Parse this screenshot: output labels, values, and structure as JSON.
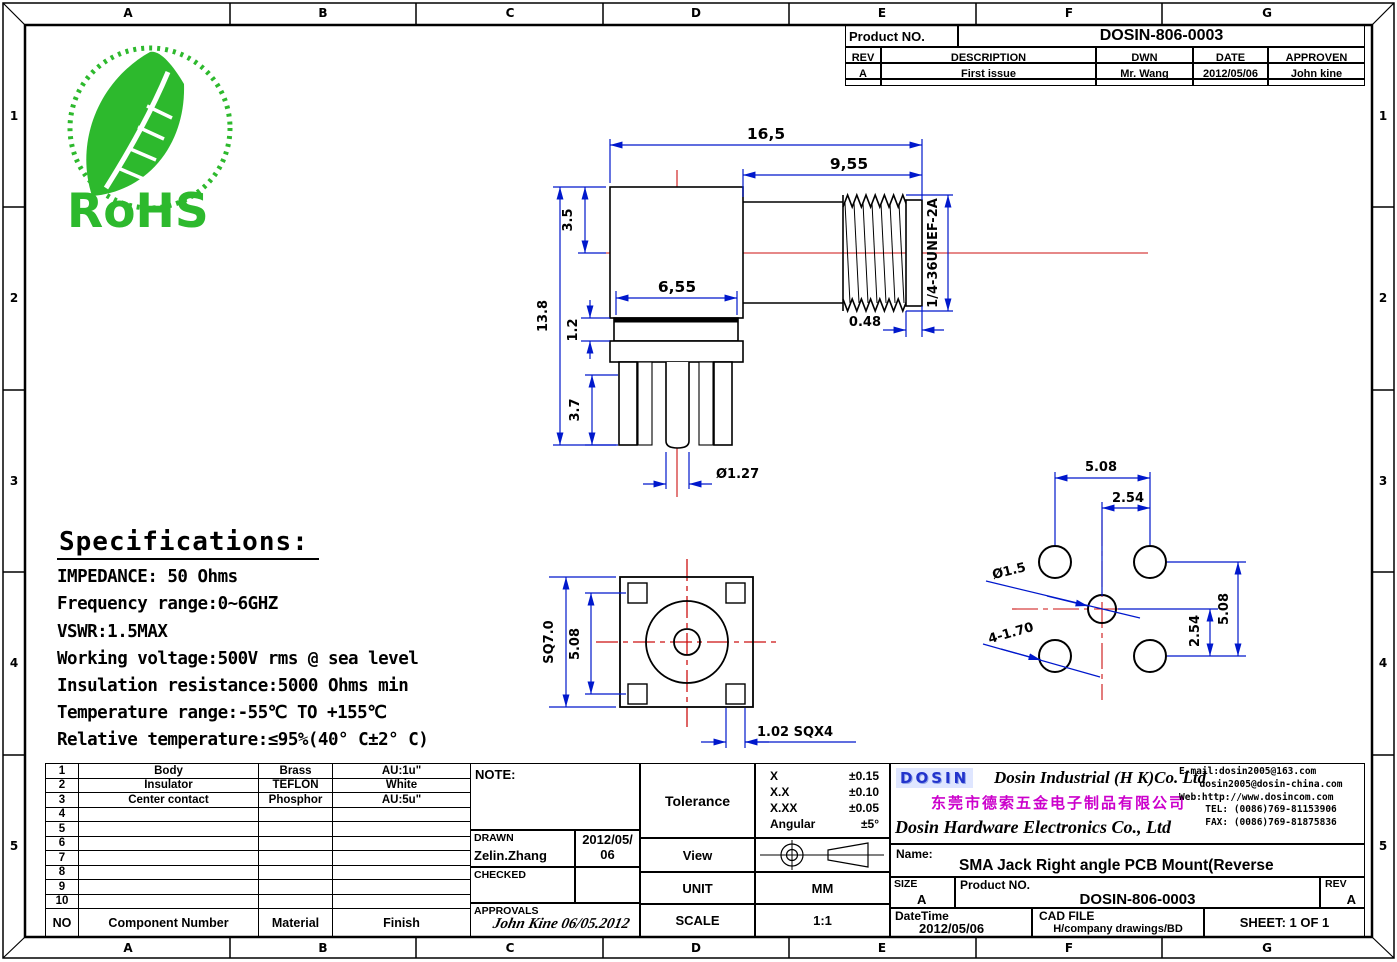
{
  "border": {
    "columns": [
      "A",
      "B",
      "C",
      "D",
      "E",
      "F",
      "G"
    ],
    "rows": [
      "1",
      "2",
      "3",
      "4",
      "5"
    ]
  },
  "rohs": {
    "label": "RoHS",
    "color": "#2db92d"
  },
  "title_block": {
    "product_no_label": "Product NO.",
    "product_no": "DOSIN-806-0003",
    "headers": {
      "rev": "REV",
      "description": "DESCRIPTION",
      "dwn": "DWN",
      "date": "DATE",
      "approven": "APPROVEN"
    },
    "row": {
      "rev": "A",
      "description": "First issue",
      "dwn": "Mr. Wang",
      "date": "2012/05/06",
      "approven": "John kine"
    }
  },
  "specifications": {
    "title": "Specifications:",
    "lines": [
      "IMPEDANCE: 50 Ohms",
      "Frequency range:0~6GHZ",
      "VSWR:1.5MAX",
      "Working voltage:500V rms @ sea level",
      "Insulation resistance:5000 Ohms min",
      "Temperature range:-55℃ TO +155℃",
      "Relative temperature:≤95%(40° C±2° C)"
    ]
  },
  "dims": {
    "side": {
      "overall": "16,5",
      "thread_len": "9,55",
      "offset": "3.5",
      "height": "13.8",
      "body": "6,55",
      "flange": "1.2",
      "legs": "3.7",
      "pin": "Ø1.27",
      "thread": "1/4-36UNEF-2A",
      "washer": "0.48"
    },
    "front": {
      "square": "SQ7.0",
      "pitch": "5.08",
      "leg": "1.02 SQX4"
    },
    "fp": {
      "top": "5.08",
      "top_half": "2.54",
      "right": "5.08",
      "right_half": "2.54",
      "center": "Ø1.5",
      "holes": "4-1.70"
    }
  },
  "components": {
    "rows": [
      {
        "no": "1",
        "name": "Body",
        "material": "Brass",
        "finish": "AU:1u\""
      },
      {
        "no": "2",
        "name": "Insulator",
        "material": "TEFLON",
        "finish": "White"
      },
      {
        "no": "3",
        "name": "Center contact",
        "material": "Phosphor",
        "finish": "AU:5u\""
      },
      {
        "no": "4",
        "name": "",
        "material": "",
        "finish": ""
      },
      {
        "no": "5",
        "name": "",
        "material": "",
        "finish": ""
      },
      {
        "no": "6",
        "name": "",
        "material": "",
        "finish": ""
      },
      {
        "no": "7",
        "name": "",
        "material": "",
        "finish": ""
      },
      {
        "no": "8",
        "name": "",
        "material": "",
        "finish": ""
      },
      {
        "no": "9",
        "name": "",
        "material": "",
        "finish": ""
      },
      {
        "no": "10",
        "name": "",
        "material": "",
        "finish": ""
      }
    ],
    "footer": {
      "no": "NO",
      "name": "Component Number",
      "material": "Material",
      "finish": "Finish"
    }
  },
  "note": {
    "label": "NOTE:"
  },
  "drawn": {
    "label": "DRAWN",
    "name": "Zelin.Zhang",
    "date_line1": "2012/05/",
    "date_line2": "06"
  },
  "checked": {
    "label": "CHECKED"
  },
  "approvals": {
    "label": "APPROVALS",
    "signature": "John Kine 06/05.2012"
  },
  "tolerance": {
    "label": "Tolerance",
    "rows": [
      [
        "X",
        "±0.15"
      ],
      [
        "X.X",
        "±0.10"
      ],
      [
        "X.XX",
        "±0.05"
      ],
      [
        "Angular",
        "±5°"
      ]
    ]
  },
  "view": {
    "label": "View"
  },
  "unit": {
    "label": "UNIT",
    "value": "MM"
  },
  "scale": {
    "label": "SCALE",
    "value": "1:1"
  },
  "company": {
    "logo": "DOSIN",
    "name_en1": "Dosin Industrial (H K)Co. Ltd",
    "name_cn": "东莞市德索五金电子制品有限公司",
    "name_en2": "Dosin Hardware Electronics Co., Ltd",
    "contact": [
      "E-mail:dosin2005@163.com",
      "dosin2005@dosin-china.com",
      "Web:http://www.dosincom.com",
      "TEL: (0086)769-81153906",
      "FAX: (0086)769-81875836"
    ]
  },
  "name_row": {
    "label": "Name:",
    "value": "SMA Jack Right angle PCB Mount(Reverse"
  },
  "size_row": {
    "size_label": "SIZE",
    "size": "A",
    "product_label": "Product NO.",
    "product_no": "DOSIN-806-0003",
    "rev_label": "REV",
    "rev": "A"
  },
  "date_row": {
    "date_label": "DateTime",
    "date": "2012/05/06",
    "cad_label": "CAD FILE",
    "cad": "H/company drawings/BD",
    "sheet": "SHEET: 1 OF 1"
  }
}
